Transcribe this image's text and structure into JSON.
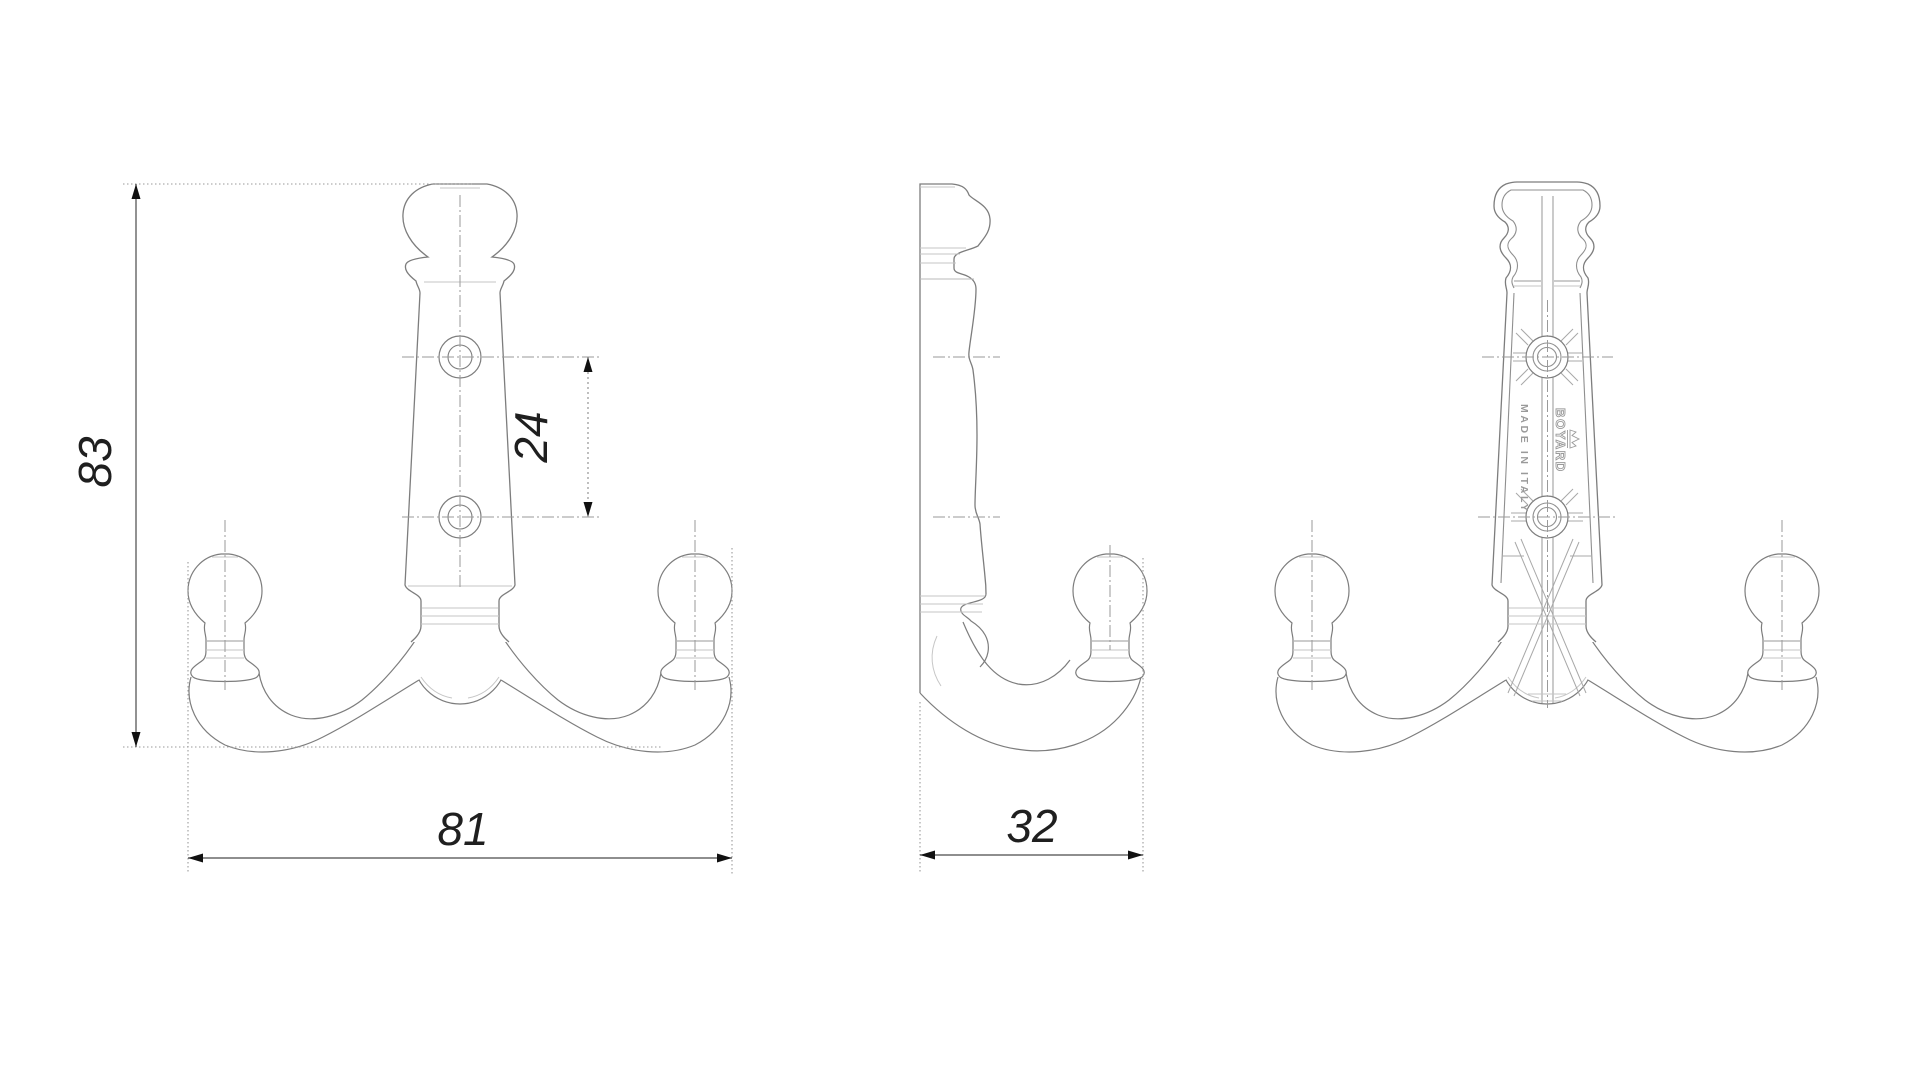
{
  "drawing": {
    "type": "technical-drawing",
    "part": "double coat hook, three orthographic views",
    "dimensions": {
      "overall_height": "83",
      "overall_width": "81",
      "hole_spacing": "24",
      "depth": "32"
    },
    "branding": {
      "brand": "BOYARD",
      "origin": "MADE IN ITALY"
    },
    "colors": {
      "background": "#ffffff",
      "outline": "#7d7d7d",
      "light_line": "#c6c6c6",
      "detail_line": "#9a9a9a",
      "rib_line": "#a8a8a8",
      "dimension_line": "#4a4a4a",
      "extension_line": "#9a9a9a",
      "text": "#1f1f1f"
    }
  }
}
